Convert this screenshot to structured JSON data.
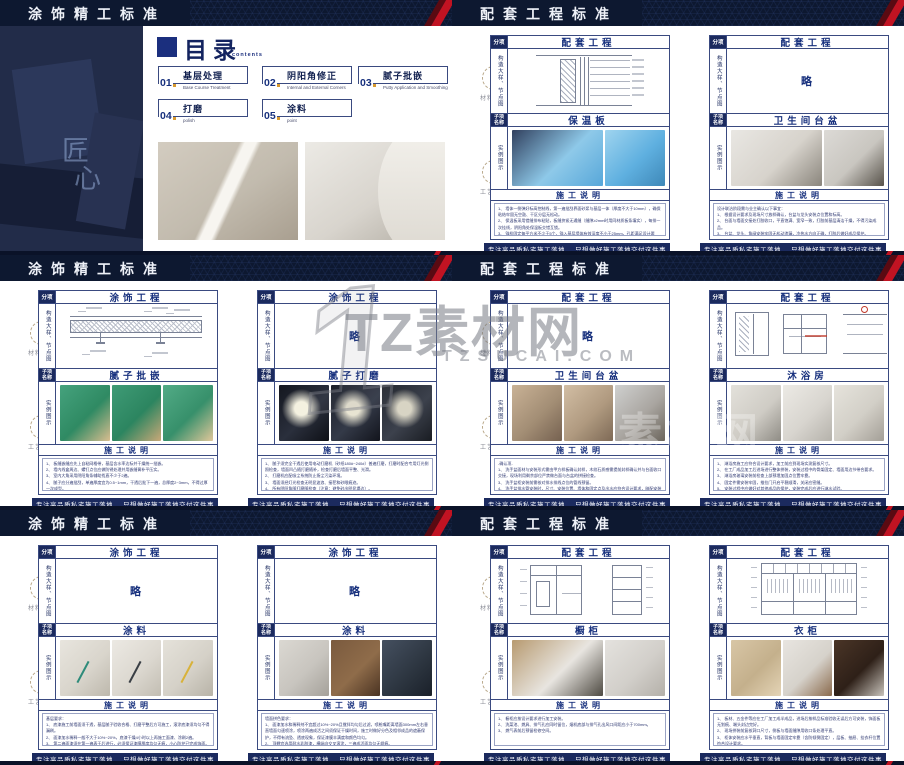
{
  "page": {
    "footer_left": "专注高品质私宅施工落地",
    "footer_right": "只想做好施工落地交付这件事"
  },
  "labels": {
    "category": "分项",
    "detail": "构造大样、节点图",
    "subitem_line1": "子项",
    "subitem_line2": "名称",
    "example": "实例图示",
    "instructions": "施工说明",
    "omitted": "略"
  },
  "side_rail": {
    "item1": "材料甄选",
    "item2": "工艺甄选"
  },
  "watermark": {
    "numeral": "1",
    "brand": "TZ素材网",
    "domain": "TZSUCAI.COM",
    "echo": "素材网",
    "color": "#7c7f88"
  },
  "colors": {
    "navy_dark": "#0d1830",
    "navy_cell": "#1b2a5e",
    "panel_border": "#3a4a80",
    "title_blue": "#17307d",
    "accent_red": "#c11322",
    "accent_orange": "#d89a2e"
  },
  "toc": {
    "header": "涂饰精工标准",
    "title": "目录",
    "subtitle": "contents",
    "craft": [
      "匠",
      "心"
    ],
    "items": [
      {
        "num": "01",
        "title": "基层处理",
        "sub": "Base Course Treatment"
      },
      {
        "num": "02",
        "title": "阴阳角修正",
        "sub": "Internal and External Corners"
      },
      {
        "num": "03",
        "title": "腻子批嵌",
        "sub": "Putty Application and Smoothing"
      },
      {
        "num": "04",
        "title": "打磨",
        "sub": "polish"
      },
      {
        "num": "05",
        "title": "涂料",
        "sub": "point"
      }
    ],
    "photos": [
      {
        "g": [
          "#d3ccc0",
          "#c2bbae",
          "#a99f90"
        ],
        "stripe": true
      },
      {
        "g": [
          "#eceae5",
          "#d8d4cd",
          "#b0aba1"
        ]
      }
    ]
  },
  "slides": [
    {
      "header": "配套工程标准",
      "panels": [
        {
          "category": "配套工程",
          "sub": "保温板",
          "diagram": "wall-section",
          "photos": [
            {
              "f": 1.5,
              "g": [
                "#31405e",
                "#8ec9e9",
                "#57a7d9"
              ]
            },
            {
              "f": 1,
              "g": [
                "#9fd4ef",
                "#5fb0e0",
                "#3e88b8"
              ]
            }
          ],
          "notes": [
            "1、 墙体一侧弹好标高控制线，第一遍批刮界面砂浆与基层一体（厚度不大于10mm），确保粘结牢固无空鼓、干区分层无松动。",
            "2、 保温板采用错缝排布粘贴，板缝挤紧无通缝（缝隙≥2mm时用同材质板条填实），每排一次挂线，阴阳角处保温板交错互锁。",
            "3、 锚栓固定每平方米不少于5个，锚入基层墙体有效深度不小于25mm，孔距满足设计要求；验收合格后方可进入下道工序，周围孔洞应用发泡剂填实，板面平整度偏差不大于4mm/2.5mm。",
            "4、 施工环境温度不宜低于5℃，卫生间等有防水要求部位应采用憎水型保温板 做完防水后施工，严禁干燥前扰动，完工后及时成品保护。"
          ]
        },
        {
          "category": "配套工程",
          "sub": "卫生间台盆",
          "diagram": "omitted",
          "photos": [
            {
              "f": 1.5,
              "g": [
                "#e9e7e3",
                "#d7d3cc",
                "#8a857c"
              ]
            },
            {
              "f": 1,
              "g": [
                "#dcdad6",
                "#c9c6c0",
                "#57524a"
              ]
            }
          ],
          "notes": [
            "设计联洽阶段需与业主确认以下事宜：",
            "1、 根据设计要求及现场尺寸放样确认，台盆与龙头安装点位置和标高。",
            "2、 台面与墙面交接处打胶收口，平直饱满、宽窄一致，打胶前基层清洁干燥，不得污染成品。",
            "3、 台盆、龙头、角阀安装牢固无松动渗漏，冷热水方向正确，打胶后做好成品保护。",
            "4、 排水配件连接严密，按规定做通水试验。",
            "5、 五金件表面无划伤痕迹，安装完成后检查顺直、平直，台盆内无遗留杂物、平整。",
            "6、 每套卫生间洁具与台面、镜柜、电器等按综合点位图进行系统复核并做好交接。（详下页）"
          ]
        }
      ]
    },
    {
      "header": "涂饰精工标准",
      "panels": [
        {
          "category": "涂饰工程",
          "sub": "腻子批嵌",
          "diagram": "ceiling-section",
          "photos": [
            {
              "g": [
                "#45a27d",
                "#2f8a63",
                "#d9bd8f"
              ]
            },
            {
              "g": [
                "#3f9b76",
                "#2c8560",
                "#c9a878"
              ]
            },
            {
              "g": [
                "#52ab86",
                "#37906b",
                "#e0c79a"
              ]
            }
          ],
          "notes": [
            "1、 板缝嵌缝应先上自粘网格带，基层含水率达标并干燥统一批嵌。",
            "2、 墙内线盒周边、螺钉点位应做防锈处理并用嵌缝膏补平压实。",
            "3、 室内大角采用阴阳角条辅助找直不少于2遍。",
            "4、 腻子应分遍批刮，单遍厚度宜为0.5~1mm，干透后批下一遍，总厚度2~3mm，不得过厚一次成型。",
            "5、 批嵌顺序自上而下先顶棚后墙面，接茬处顺平压实，每遍批嵌完成后检查平整度。（偏差≤3mm），过厚部位铲除重新批嵌找平。",
            "6、 批嵌完成后检查无明显接茬、砂眼，墙面批嵌平整如一，阴阳角方正顺直。",
            "7、 腻子必须晾干后打磨。"
          ]
        },
        {
          "category": "涂饰工程",
          "sub": "腻子打磨",
          "diagram": "omitted",
          "photos": [
            {
              "g": [
                "#14171f",
                "#2a2f3c",
                "#0e1016"
              ],
              "r": "#f4f1e0"
            },
            {
              "g": [
                "#1a1e28",
                "#343a48",
                "#12141c"
              ],
              "r": "#e8e4d2"
            },
            {
              "g": [
                "#23272f",
                "#3c414c",
                "#191c22"
              ],
              "r": "#d8d4c4"
            }
          ],
          "notes": [
            "1、 腻子须完全干透后使用电动打磨机（砂纸180#~240#）普遍打磨，打磨时配合专用灯光侧照检查，墙面凹凸随打磨随补，检查打磨后墙面平整、光滑。",
            "2、 打磨机应配吸尘系统防止扬尘污染环境。",
            "3、 墙面须经灯光检查无明显波浪、接茬和砂眼痕迹。",
            "4、 所有阴阳角随打磨随检查（注意：避免砂出明显塌边）。",
            "5、 清理后检查墙面阴阳角顺直度不大于2mm。",
            "6、 打磨完成后及时清理浮灰，打磨验收合格后进行底漆施工。"
          ]
        }
      ]
    },
    {
      "header": "配套工程标准",
      "panels": [
        {
          "category": "配套工程",
          "sub": "卫生间台盆",
          "diagram": "omitted",
          "photos": [
            {
              "g": [
                "#c9b296",
                "#a38e75",
                "#756150"
              ]
            },
            {
              "g": [
                "#d2bea4",
                "#b09a80",
                "#7e6a56"
              ]
            },
            {
              "g": [
                "#cfd0cf",
                "#a9a5a0",
                "#6b655c"
              ]
            }
          ],
          "notes": [
            "-确认项-",
            "1、 洗手盆面材与安装形式需由甲方样板确认封样，木纹石质感需提前封样确认并与台面收口交接，现场利用剩余部位严禁做台面与台盆的拼接检查。",
            "3、 洗手盆柜安装前需核对排水排线点位的管线预留。",
            "4、 洗手盆排水管安装时，尺寸、安装位置、墙体和固定点及出水应符合设计要求，暗配安装必须核对。",
            "10、 洗手盆侧阴角的打胶、排线应符合设计要求，配件应牢，安装后可用。",
            "11、 洗手盆间柜门开启方便灵活、不碰镜面及五金，做好成品保护。"
          ]
        },
        {
          "category": "配套工程",
          "sub": "沐浴房",
          "diagram": "shower-details",
          "photos": [
            {
              "g": [
                "#e3e1db",
                "#cfccc5",
                "#8f8c85"
              ]
            },
            {
              "g": [
                "#eceae5",
                "#d8d5cf",
                "#b5b2ab"
              ]
            },
            {
              "g": [
                "#e6e3dc",
                "#d2cfc7",
                "#a39f97"
              ]
            }
          ],
          "notes": [
            "1、 淋浴房施工应符合设计要求，加工前应到现场实测复核尺寸。",
            "2、 在工厂成品加工后进场进行整体拼装，安装过程中的骨架固定、墙面用边节带合要求。",
            "3、 淋浴房玻璃安装前检查上部预埋加固点位置牢靠。",
            "4、 固定件需安装牢固，推拉门开启平稳顺滑，关闭应密缝。",
            "5、 安装过程中应做好对其他成品的保护，安装完成后应进行淋水试验。"
          ]
        }
      ]
    },
    {
      "header": "涂饰精工标准",
      "panels": [
        {
          "category": "涂饰工程",
          "sub": "涂料",
          "diagram": "omitted",
          "photos": [
            {
              "g": [
                "#e8e5de",
                "#d9d5cc",
                "#bdb8ac"
              ],
              "stick": "#2e8b7a"
            },
            {
              "g": [
                "#ece9e3",
                "#dcd8d0",
                "#c2bdb2"
              ],
              "stick": "#3a3f45"
            },
            {
              "g": [
                "#e5e2da",
                "#d5d1c8",
                "#b8b3a7"
              ],
              "stick": "#d8b23a"
            }
          ],
          "notes": [
            "基层要求：",
            "1、 底漆施工前墙面须干透，基层腻子验收合格、打磨平整后方可施工，滚涂底漆须均匀不得漏刷。",
            "2、 面漆加水稀释一般不大于10%~20%，底漆干燥4小时以上再施工面漆、涂刷2遍。",
            "3、 第二遍面漆须在第一遍表干后进行，必须保证漆膜厚度均匀无痕，小心防护已完成饰面。",
            "注：",
            "1、 涂料施工温度应保持在5℃以上一致施工，干燥期间注意通风防尘。",
            "2、 喷涂施工按先顶棚后墙面自上而下顺序，墙角及阴影部位需单独补一遍喷涂。",
            "3、 涂料施工完成后（墙面涂料）做好不上人保护。"
          ]
        },
        {
          "category": "涂饰工程",
          "sub": "涂料",
          "diagram": "omitted",
          "photos": [
            {
              "g": [
                "#dbd8d2",
                "#c8c5bf",
                "#a5a19a"
              ]
            },
            {
              "g": [
                "#7a5a3e",
                "#8f6c4a",
                "#4a3322"
              ]
            },
            {
              "g": [
                "#455060",
                "#2e3742",
                "#1a2029"
              ]
            }
          ],
          "notes": [
            "墙面拼色要求：",
            "1、 面漆加水和稀释剂不宜超过10%~20%且搅拌均匀后过滤，喷枪嘴距离墙面300mm左右垂直墙面匀速喷涂，喷涂两遍成活之间须保证干燥时间，施工时做好分色及相邻成品的遮蔽保护，不得有流坠、透底现象，保证漆膜丰满度和颜色均匀。",
            "2、 顶棚宜选用耐水乳胶漆，横纵向交叉滚涂，三遍成活面均匀无辊痕。",
            "3、 相邻两墙面颜色不同时需先做好分色弹线与美纹纸遮蔽，分色线平直、无渗色。",
            "4、 空调风口、灯具、开关面板等安装部位预留准确，污染部位及时清理。",
            "5、 涂料干燥前做好防尘、防磕碰，验收合格后撤除下表保护。"
          ]
        }
      ]
    },
    {
      "header": "配套工程标准",
      "panels": [
        {
          "category": "配套工程",
          "sub": "橱柜",
          "diagram": "cabinet-details",
          "photos": [
            {
              "f": 1.5,
              "g": [
                "#b79a70",
                "#e8e5e0",
                "#4e4a42"
              ]
            },
            {
              "f": 1,
              "g": [
                "#e4e2de",
                "#d2cfca",
                "#b4b0a9"
              ]
            }
          ],
          "notes": [
            "1、 橱柜应按设计要求进行加工安装。",
            "2、 洗菜池、燃具、排气孔应同时留位，烟机底部与排气孔出风口间距应小于700mm。",
            "3、 燃气表前后预留检修空间。"
          ]
        },
        {
          "category": "配套工程",
          "sub": "衣柜",
          "diagram": "wardrobe-elevation",
          "photos": [
            {
              "g": [
                "#d8c6a6",
                "#c4b08c",
                "#e4d4b6"
              ]
            },
            {
              "g": [
                "#e8e5e0",
                "#d6d2cb",
                "#8a6a4c"
              ]
            },
            {
              "g": [
                "#4a3527",
                "#2e2018",
                "#c9c4bc"
              ]
            }
          ],
          "notes": [
            "1、 板材、五金件等应在工厂加工成半成品，进场后按样品标准验收无误后方可安装，饰面板无划痕、端头封边完好。",
            "2、 现场拼装前复核洞口尺寸，侧板与墙面缝隙用收口条处理平直。",
            "3、 柜体安装应水平垂直，背板与墙面固定牢靠（含防倾倒固定），层板、抽屉、挂衣杆位置符合设计要求。",
            "4、 柜门、抽屉开合顺畅，缝隙均匀一致，铰链、滑轨等五金安装牢固，拉手无松动，所有紧固件隐蔽部位做防潮处理，柜体内部清洁。",
            "5、 灯带、感应器等电气预留点位准确，接线安全隐蔽可靠。",
            "6、 收口线条、饰面对花，严禁现场切割后断面外露不封边，转角处45°拼接。",
            "7、 安装完成后做好保护，不磕碰、清理现场。"
          ]
        }
      ]
    }
  ]
}
